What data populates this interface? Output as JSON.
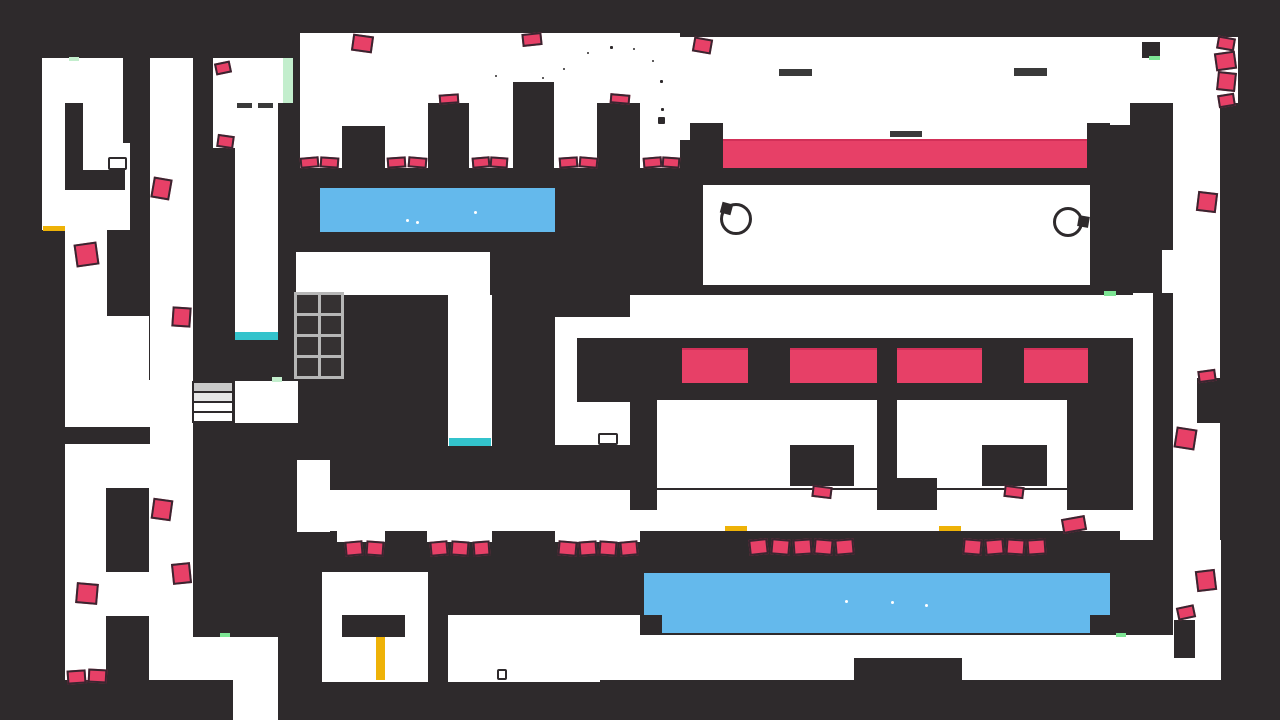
{
  "meta": {
    "title": "platformer-level",
    "width": 1280,
    "height": 720
  },
  "palette": {
    "background": "#2e2a2c",
    "room_white": "#ffffff",
    "hazard_pink": "#e74067",
    "lava_pink": "#e74067",
    "water_blue": "#64b9ec",
    "mint_pale": "#c3eecd",
    "mint_bright": "#7de594",
    "gold": "#eeb207",
    "cyan": "#33c3cc",
    "ledge_gray": "#3a3a3a",
    "tile_line_gray": "#b6b6b6"
  },
  "shapes": {
    "white_regions": [
      {
        "x": 42,
        "y": 58,
        "w": 88,
        "h": 172
      },
      {
        "x": 65,
        "y": 230,
        "w": 42,
        "h": 150
      },
      {
        "x": 107,
        "y": 316,
        "w": 42,
        "h": 172
      },
      {
        "x": 65,
        "y": 380,
        "w": 85,
        "h": 47
      },
      {
        "x": 65,
        "y": 444,
        "w": 85,
        "h": 236
      },
      {
        "x": 106,
        "y": 572,
        "w": 43,
        "h": 44
      },
      {
        "x": 150,
        "y": 58,
        "w": 43,
        "h": 622
      },
      {
        "x": 213,
        "y": 58,
        "w": 22,
        "h": 90
      },
      {
        "x": 235,
        "y": 58,
        "w": 43,
        "h": 282
      },
      {
        "x": 278,
        "y": 58,
        "w": 15,
        "h": 45
      },
      {
        "x": 235,
        "y": 381,
        "w": 63,
        "h": 42
      },
      {
        "x": 297,
        "y": 460,
        "w": 33,
        "h": 72
      },
      {
        "x": 192,
        "y": 637,
        "w": 86,
        "h": 43
      },
      {
        "x": 233,
        "y": 680,
        "w": 45,
        "h": 40
      },
      {
        "x": 300,
        "y": 33,
        "w": 380,
        "h": 135
      },
      {
        "x": 680,
        "y": 37,
        "w": 480,
        "h": 103
      },
      {
        "x": 1160,
        "y": 37,
        "w": 78,
        "h": 66
      },
      {
        "x": 1173,
        "y": 103,
        "w": 47,
        "h": 190
      },
      {
        "x": 1162,
        "y": 250,
        "w": 11,
        "h": 43
      },
      {
        "x": 703,
        "y": 185,
        "w": 387,
        "h": 100
      },
      {
        "x": 630,
        "y": 295,
        "w": 523,
        "h": 43
      },
      {
        "x": 555,
        "y": 317,
        "w": 75,
        "h": 128
      },
      {
        "x": 296,
        "y": 252,
        "w": 194,
        "h": 43
      },
      {
        "x": 448,
        "y": 295,
        "w": 44,
        "h": 151
      },
      {
        "x": 1133,
        "y": 293,
        "w": 20,
        "h": 247
      },
      {
        "x": 1120,
        "y": 510,
        "w": 33,
        "h": 30
      },
      {
        "x": 657,
        "y": 400,
        "w": 220,
        "h": 88
      },
      {
        "x": 897,
        "y": 400,
        "w": 170,
        "h": 88
      },
      {
        "x": 300,
        "y": 490,
        "w": 831,
        "h": 41
      },
      {
        "x": 337,
        "y": 531,
        "w": 48,
        "h": 11
      },
      {
        "x": 427,
        "y": 531,
        "w": 65,
        "h": 11
      },
      {
        "x": 555,
        "y": 531,
        "w": 85,
        "h": 11
      },
      {
        "x": 322,
        "y": 572,
        "w": 106,
        "h": 110
      },
      {
        "x": 448,
        "y": 615,
        "w": 152,
        "h": 67
      },
      {
        "x": 600,
        "y": 615,
        "w": 40,
        "h": 43
      },
      {
        "x": 597,
        "y": 635,
        "w": 624,
        "h": 45
      },
      {
        "x": 1173,
        "y": 293,
        "w": 47,
        "h": 287
      },
      {
        "x": 1173,
        "y": 540,
        "w": 48,
        "h": 95
      }
    ],
    "dark_blocks": [
      {
        "x": 65,
        "y": 103,
        "w": 18,
        "h": 87
      },
      {
        "x": 83,
        "y": 170,
        "w": 42,
        "h": 20
      },
      {
        "x": 123,
        "y": 58,
        "w": 27,
        "h": 85
      },
      {
        "x": 60,
        "y": 427,
        "w": 90,
        "h": 17
      },
      {
        "x": 106,
        "y": 488,
        "w": 43,
        "h": 84
      },
      {
        "x": 106,
        "y": 616,
        "w": 43,
        "h": 64
      },
      {
        "x": 342,
        "y": 126,
        "w": 43,
        "h": 42
      },
      {
        "x": 428,
        "y": 103,
        "w": 41,
        "h": 65
      },
      {
        "x": 513,
        "y": 82,
        "w": 41,
        "h": 86
      },
      {
        "x": 597,
        "y": 103,
        "w": 43,
        "h": 65
      },
      {
        "x": 690,
        "y": 123,
        "w": 33,
        "h": 45
      },
      {
        "x": 1087,
        "y": 123,
        "w": 23,
        "h": 45
      },
      {
        "x": 1130,
        "y": 103,
        "w": 30,
        "h": 65
      },
      {
        "x": 1088,
        "y": 125,
        "w": 72,
        "h": 43
      },
      {
        "x": 1142,
        "y": 42,
        "w": 18,
        "h": 16
      },
      {
        "x": 577,
        "y": 338,
        "w": 53,
        "h": 64
      },
      {
        "x": 790,
        "y": 445,
        "w": 64,
        "h": 41
      },
      {
        "x": 982,
        "y": 445,
        "w": 65,
        "h": 41
      },
      {
        "x": 630,
        "y": 400,
        "w": 27,
        "h": 110
      },
      {
        "x": 877,
        "y": 400,
        "w": 20,
        "h": 78
      },
      {
        "x": 877,
        "y": 478,
        "w": 60,
        "h": 32
      },
      {
        "x": 1067,
        "y": 400,
        "w": 65,
        "h": 110
      },
      {
        "x": 342,
        "y": 615,
        "w": 63,
        "h": 22
      },
      {
        "x": 854,
        "y": 658,
        "w": 108,
        "h": 22
      },
      {
        "x": 1174,
        "y": 620,
        "w": 21,
        "h": 38
      },
      {
        "x": 1197,
        "y": 378,
        "w": 24,
        "h": 45
      }
    ],
    "lava_pools": [
      {
        "x": 723,
        "y": 139,
        "w": 364,
        "h": 29
      },
      {
        "x": 682,
        "y": 348,
        "w": 66,
        "h": 35
      },
      {
        "x": 790,
        "y": 348,
        "w": 87,
        "h": 35
      },
      {
        "x": 897,
        "y": 348,
        "w": 85,
        "h": 35
      },
      {
        "x": 1024,
        "y": 348,
        "w": 64,
        "h": 35
      }
    ],
    "water_pools": [
      {
        "x": 320,
        "y": 188,
        "w": 235,
        "h": 44
      },
      {
        "x": 644,
        "y": 573,
        "w": 466,
        "h": 42
      },
      {
        "x": 662,
        "y": 615,
        "w": 428,
        "h": 18
      }
    ],
    "water_bubbles": [
      {
        "x": 406,
        "y": 219
      },
      {
        "x": 416,
        "y": 221
      },
      {
        "x": 474,
        "y": 211
      },
      {
        "x": 845,
        "y": 600
      },
      {
        "x": 891,
        "y": 601
      },
      {
        "x": 925,
        "y": 604
      }
    ],
    "hazards": [
      {
        "x": 75,
        "y": 243,
        "w": 23,
        "h": 23,
        "rot": -8
      },
      {
        "x": 152,
        "y": 178,
        "w": 19,
        "h": 21,
        "rot": 10
      },
      {
        "x": 172,
        "y": 307,
        "w": 19,
        "h": 20,
        "rot": 4
      },
      {
        "x": 152,
        "y": 499,
        "w": 20,
        "h": 21,
        "rot": 8
      },
      {
        "x": 172,
        "y": 563,
        "w": 19,
        "h": 21,
        "rot": -6
      },
      {
        "x": 76,
        "y": 583,
        "w": 22,
        "h": 21,
        "rot": 5
      },
      {
        "x": 67,
        "y": 670,
        "w": 19,
        "h": 14,
        "rot": -4
      },
      {
        "x": 88,
        "y": 669,
        "w": 19,
        "h": 14,
        "rot": 3
      },
      {
        "x": 215,
        "y": 62,
        "w": 16,
        "h": 12,
        "rot": -12
      },
      {
        "x": 217,
        "y": 135,
        "w": 17,
        "h": 13,
        "rot": 8
      },
      {
        "x": 352,
        "y": 35,
        "w": 21,
        "h": 17,
        "rot": 8
      },
      {
        "x": 522,
        "y": 33,
        "w": 20,
        "h": 13,
        "rot": -6
      },
      {
        "x": 693,
        "y": 38,
        "w": 19,
        "h": 15,
        "rot": 10
      },
      {
        "x": 300,
        "y": 157,
        "w": 19,
        "h": 11,
        "rot": -5
      },
      {
        "x": 320,
        "y": 157,
        "w": 19,
        "h": 11,
        "rot": 4
      },
      {
        "x": 387,
        "y": 157,
        "w": 19,
        "h": 11,
        "rot": -4
      },
      {
        "x": 408,
        "y": 157,
        "w": 19,
        "h": 11,
        "rot": 5
      },
      {
        "x": 472,
        "y": 157,
        "w": 18,
        "h": 11,
        "rot": -5
      },
      {
        "x": 490,
        "y": 157,
        "w": 18,
        "h": 11,
        "rot": 4
      },
      {
        "x": 559,
        "y": 157,
        "w": 19,
        "h": 11,
        "rot": -4
      },
      {
        "x": 579,
        "y": 157,
        "w": 19,
        "h": 11,
        "rot": 5
      },
      {
        "x": 643,
        "y": 157,
        "w": 19,
        "h": 11,
        "rot": -5
      },
      {
        "x": 662,
        "y": 157,
        "w": 18,
        "h": 11,
        "rot": 4
      },
      {
        "x": 439,
        "y": 94,
        "w": 20,
        "h": 10,
        "rot": -4
      },
      {
        "x": 610,
        "y": 94,
        "w": 20,
        "h": 10,
        "rot": 5
      },
      {
        "x": 1217,
        "y": 37,
        "w": 18,
        "h": 13,
        "rot": 10
      },
      {
        "x": 1215,
        "y": 52,
        "w": 21,
        "h": 18,
        "rot": -8
      },
      {
        "x": 1217,
        "y": 72,
        "w": 19,
        "h": 19,
        "rot": 6
      },
      {
        "x": 1218,
        "y": 94,
        "w": 17,
        "h": 13,
        "rot": -9
      },
      {
        "x": 1197,
        "y": 192,
        "w": 20,
        "h": 20,
        "rot": 7
      },
      {
        "x": 1198,
        "y": 370,
        "w": 18,
        "h": 12,
        "rot": -8
      },
      {
        "x": 1175,
        "y": 428,
        "w": 21,
        "h": 21,
        "rot": 9
      },
      {
        "x": 1196,
        "y": 570,
        "w": 20,
        "h": 21,
        "rot": -7
      },
      {
        "x": 812,
        "y": 486,
        "w": 20,
        "h": 12,
        "rot": 7
      },
      {
        "x": 1004,
        "y": 486,
        "w": 20,
        "h": 12,
        "rot": 7
      },
      {
        "x": 345,
        "y": 541,
        "w": 18,
        "h": 15,
        "rot": -5
      },
      {
        "x": 366,
        "y": 541,
        "w": 18,
        "h": 15,
        "rot": 4
      },
      {
        "x": 430,
        "y": 541,
        "w": 18,
        "h": 15,
        "rot": -5
      },
      {
        "x": 451,
        "y": 541,
        "w": 18,
        "h": 15,
        "rot": 4
      },
      {
        "x": 473,
        "y": 541,
        "w": 17,
        "h": 15,
        "rot": -4
      },
      {
        "x": 558,
        "y": 541,
        "w": 19,
        "h": 15,
        "rot": 5
      },
      {
        "x": 579,
        "y": 541,
        "w": 18,
        "h": 15,
        "rot": -4
      },
      {
        "x": 599,
        "y": 541,
        "w": 18,
        "h": 15,
        "rot": 4
      },
      {
        "x": 620,
        "y": 541,
        "w": 18,
        "h": 15,
        "rot": -5
      },
      {
        "x": 749,
        "y": 539,
        "w": 19,
        "h": 16,
        "rot": -6
      },
      {
        "x": 771,
        "y": 539,
        "w": 19,
        "h": 16,
        "rot": 5
      },
      {
        "x": 793,
        "y": 539,
        "w": 19,
        "h": 16,
        "rot": -4
      },
      {
        "x": 814,
        "y": 539,
        "w": 19,
        "h": 16,
        "rot": 5
      },
      {
        "x": 835,
        "y": 539,
        "w": 19,
        "h": 16,
        "rot": -5
      },
      {
        "x": 963,
        "y": 539,
        "w": 19,
        "h": 16,
        "rot": 5
      },
      {
        "x": 985,
        "y": 539,
        "w": 19,
        "h": 16,
        "rot": -5
      },
      {
        "x": 1006,
        "y": 539,
        "w": 19,
        "h": 16,
        "rot": 4
      },
      {
        "x": 1027,
        "y": 539,
        "w": 19,
        "h": 16,
        "rot": -4
      },
      {
        "x": 1062,
        "y": 517,
        "w": 24,
        "h": 15,
        "rot": -10
      },
      {
        "x": 1177,
        "y": 606,
        "w": 18,
        "h": 13,
        "rot": -12
      }
    ],
    "mint_strips": [
      {
        "x": 69,
        "y": 57,
        "w": 10,
        "h": 4,
        "tone": "pale"
      },
      {
        "x": 283,
        "y": 58,
        "w": 10,
        "h": 45,
        "tone": "pale"
      },
      {
        "x": 1149,
        "y": 56,
        "w": 11,
        "h": 4,
        "tone": "bright"
      },
      {
        "x": 1104,
        "y": 291,
        "w": 12,
        "h": 5,
        "tone": "bright"
      },
      {
        "x": 272,
        "y": 377,
        "w": 10,
        "h": 5,
        "tone": "pale"
      },
      {
        "x": 220,
        "y": 633,
        "w": 10,
        "h": 4,
        "tone": "bright"
      },
      {
        "x": 1116,
        "y": 633,
        "w": 10,
        "h": 4,
        "tone": "bright"
      }
    ],
    "gold_strips": [
      {
        "x": 43,
        "y": 226,
        "w": 22,
        "h": 5
      },
      {
        "x": 725,
        "y": 526,
        "w": 22,
        "h": 5
      },
      {
        "x": 939,
        "y": 526,
        "w": 22,
        "h": 5
      },
      {
        "x": 376,
        "y": 637,
        "w": 9,
        "h": 43
      }
    ],
    "cyan_strips": [
      {
        "x": 235,
        "y": 332,
        "w": 43,
        "h": 8
      },
      {
        "x": 449,
        "y": 438,
        "w": 42,
        "h": 8
      }
    ],
    "gray_dashes": [
      {
        "x": 237,
        "y": 103,
        "w": 15,
        "h": 5
      },
      {
        "x": 258,
        "y": 103,
        "w": 15,
        "h": 5
      },
      {
        "x": 779,
        "y": 69,
        "w": 33,
        "h": 7
      },
      {
        "x": 1014,
        "y": 68,
        "w": 33,
        "h": 8
      },
      {
        "x": 890,
        "y": 131,
        "w": 32,
        "h": 6
      }
    ],
    "crates": [
      {
        "x": 108,
        "y": 157,
        "w": 19,
        "h": 13
      },
      {
        "x": 598,
        "y": 433,
        "w": 20,
        "h": 12
      },
      {
        "x": 497,
        "y": 669,
        "w": 10,
        "h": 11
      }
    ],
    "ring_hazards": [
      {
        "cx": 736,
        "cy": 219,
        "r": 16,
        "anchor": {
          "x": 721,
          "y": 203,
          "w": 11,
          "h": 11,
          "rot": 15
        }
      },
      {
        "cx": 1068,
        "cy": 222,
        "r": 15,
        "anchor": {
          "x": 1078,
          "y": 216,
          "w": 11,
          "h": 11,
          "rot": 10
        }
      }
    ],
    "tile_grid": {
      "x": 294,
      "y": 292,
      "w": 50,
      "h": 87,
      "cols": 2,
      "rows": 4,
      "line": 3
    },
    "stairs": {
      "x": 192,
      "y": 381,
      "w": 42,
      "step_h": 10,
      "fills": [
        "#c9c9c9",
        "#e6e6e6",
        "#ffffff",
        "#ffffff"
      ]
    },
    "particles": [
      {
        "x": 563,
        "y": 68,
        "s": 2
      },
      {
        "x": 587,
        "y": 52,
        "s": 2
      },
      {
        "x": 610,
        "y": 46,
        "s": 3
      },
      {
        "x": 633,
        "y": 48,
        "s": 2
      },
      {
        "x": 652,
        "y": 60,
        "s": 2
      },
      {
        "x": 660,
        "y": 80,
        "s": 3
      },
      {
        "x": 661,
        "y": 108,
        "s": 3
      },
      {
        "x": 658,
        "y": 117,
        "s": 7
      },
      {
        "x": 495,
        "y": 75,
        "s": 2
      },
      {
        "x": 542,
        "y": 77,
        "s": 2
      }
    ]
  }
}
